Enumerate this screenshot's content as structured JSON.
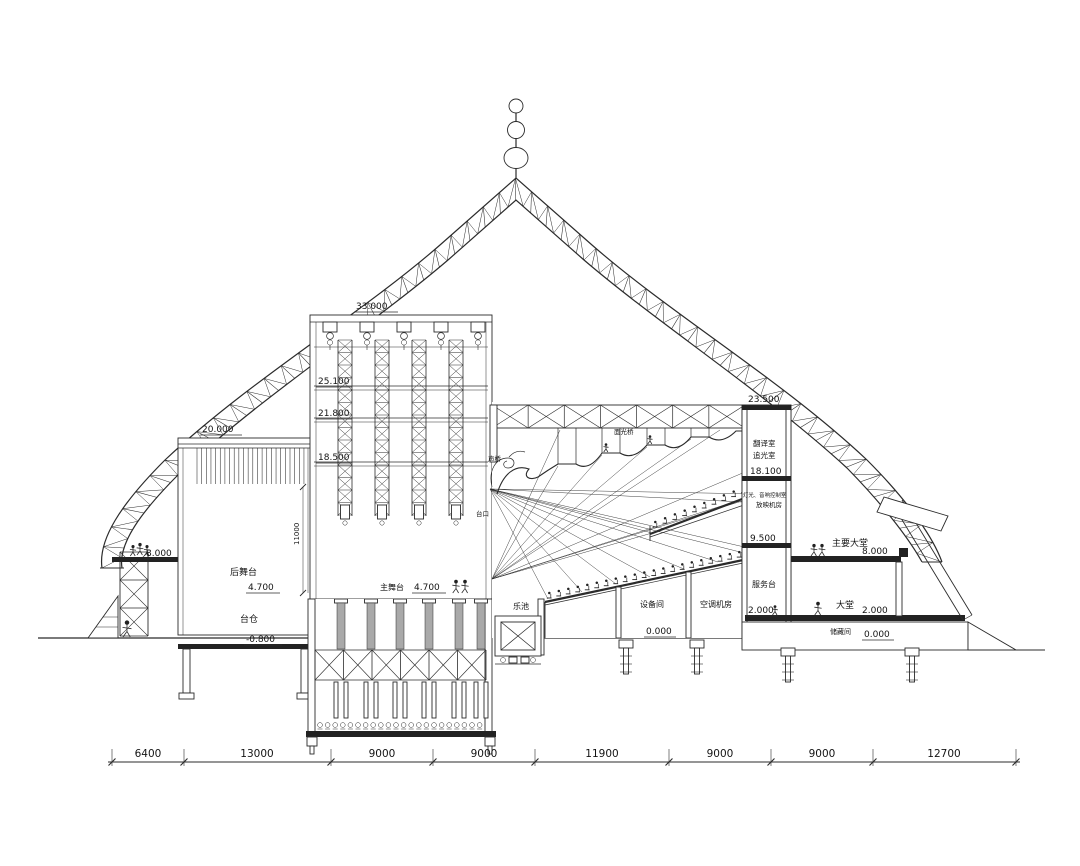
{
  "meta": {
    "type": "architectural-section-drawing",
    "subject": "theater-longitudinal-section",
    "background": "#ffffff",
    "line_color": "#2b2b2b"
  },
  "elevations": {
    "fly_tower_top": "33.000",
    "grid_25100": "25.100",
    "grid_21800": "21.800",
    "grid_18500": "18.500",
    "rear_stage_roof": "20.000",
    "left_platform": "8.000",
    "rear_stage_floor": "4.700",
    "main_stage_floor": "4.700",
    "basement_floor": "-0.800",
    "auditorium_roof": "23.500",
    "room_18100": "18.100",
    "room_9500": "9.500",
    "lobby_upper_floor": "8.000",
    "service_floor": "2.000",
    "lobby_floor": "2.000",
    "ground_mid": "0.000",
    "ground_right": "0.000"
  },
  "rooms": {
    "rear_stage": "后舞台",
    "stage_basement": "台仓",
    "main_stage": "主舞台",
    "orchestra_pit": "乐池",
    "equipment_room": "设备间",
    "ac_plant_room": "空调机房",
    "service_desk": "服务台",
    "translation_room": "翻译室",
    "followspot_room": "追光室",
    "control_room": "灯光、音响控制室",
    "projection_room": "放映机房",
    "front_light_bridge": "面光桥",
    "sound_bridge": "声桥",
    "proscenium": "台口",
    "main_lobby_upper": "主要大堂",
    "lobby": "大堂",
    "storage": "储藏间"
  },
  "dimensions": {
    "horizontal": [
      "6400",
      "13000",
      "9000",
      "9000",
      "11900",
      "9000",
      "9000",
      "12700"
    ],
    "stage_height": "11000"
  }
}
